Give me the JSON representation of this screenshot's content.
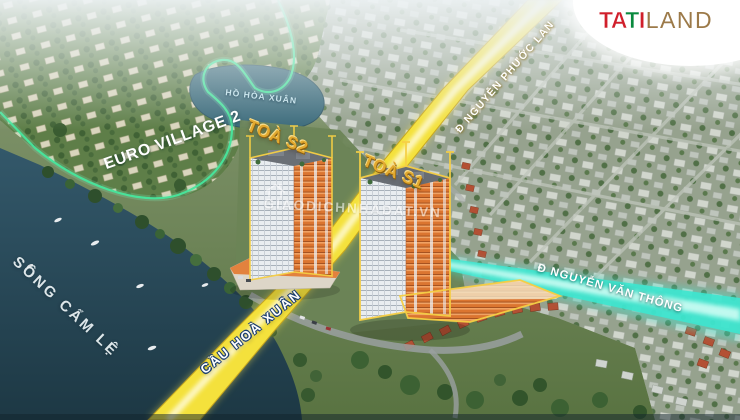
{
  "scene": {
    "description": "Aerial 3D masterplan render of two residential towers beside a river",
    "project_towers": [
      "TOÀ S2",
      "TOÀ S1"
    ]
  },
  "logo": {
    "tati_letters": [
      "T",
      "A",
      "T",
      "I"
    ],
    "land_text": "LAND",
    "colors": {
      "red": "#d01f2b",
      "green": "#0a8a3e",
      "bronze": "#9c7a49",
      "background": "#ffffff"
    }
  },
  "labels": {
    "euro_village": "EURO VILLAGE 2",
    "lake": "HỒ HÒA XUÂN",
    "tower_s2": "TOÀ S2",
    "tower_s1": "TOÀ S1",
    "road_top": "Đ NGUYỄN PHƯỚC LAN",
    "road_right": "Đ NGUYỄN VĂN THÔNG",
    "bridge": "CẦU HOÀ XUÂN",
    "river": "SÔNG CẨM LỆ",
    "watermark": "GIAODICHNHADAT.VN"
  },
  "colors": {
    "road_highlight_yellow": "#f4e13c",
    "road_highlight_cyan": "#3de6cf",
    "boundary_green": "#47e69c",
    "tower_outline_gold": "#f6cf45",
    "tower_label_gold": "#e2a92f",
    "river_water": "#2d5260",
    "lake_water": "#3a6a7a"
  }
}
